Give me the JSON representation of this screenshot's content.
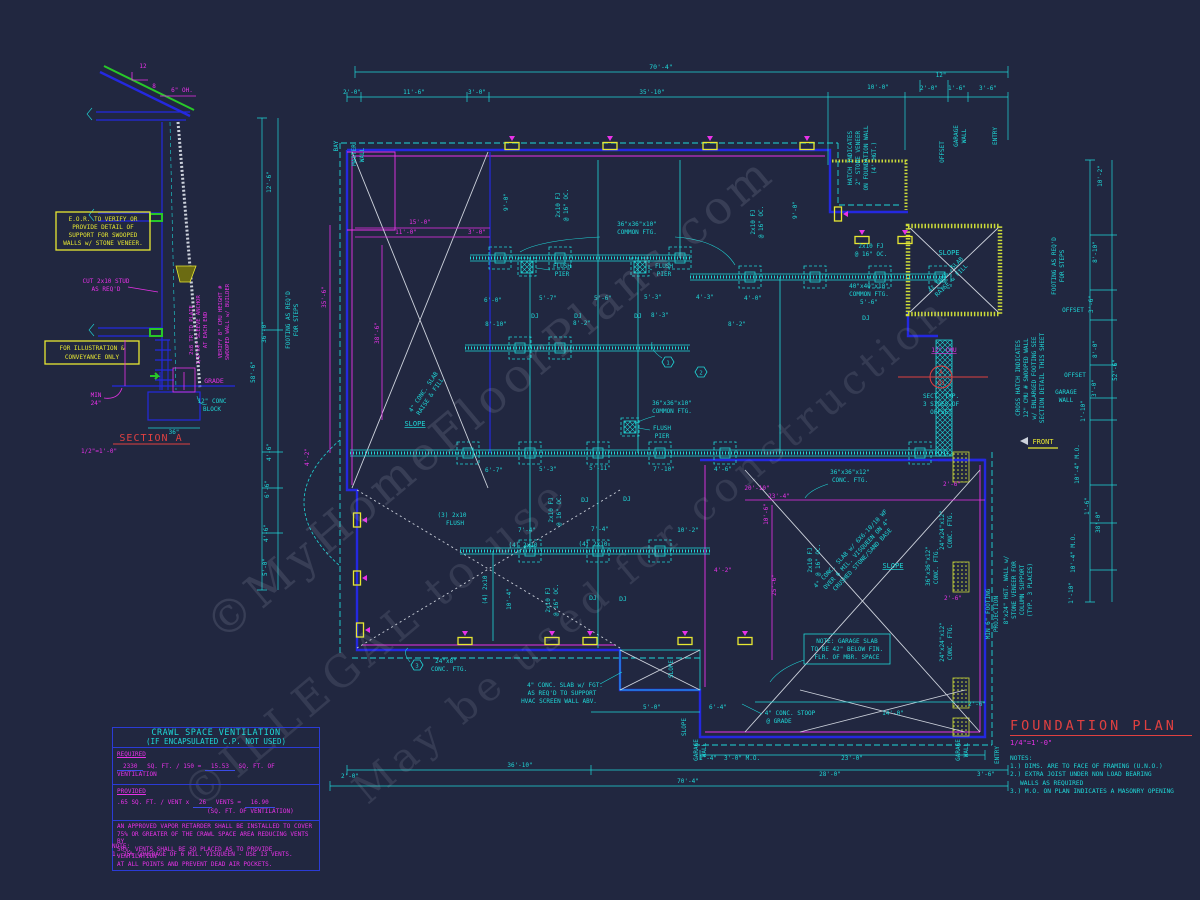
{
  "watermarks": [
    "©MyHomeFloorPlans.com",
    "©ILLEGAL to use",
    "May be used for construction"
  ],
  "section_a": {
    "pitch_rise": "12",
    "pitch_run": "8",
    "overhang": "6\" OH.",
    "note_box1": [
      "E.O.R. TO VERIFY OR",
      "PROVIDE DETAIL OF",
      "SUPPORT FOR SWOOPED",
      "WALLS w/ STONE VENEER."
    ],
    "note_box2": [
      "FOR ILLUSTRATION &",
      "CONVEYANCE ONLY"
    ],
    "cut_stud": [
      "CUT 2x10 STUD",
      "AS REQ'D"
    ],
    "anchor_note": [
      "2x8 TR'TD PLATE",
      "1/2\"x4\" SLEEVE ANCHOR",
      "AT EACH END"
    ],
    "verify_note": [
      "VERIFY 8\" CMU HEIGHT #",
      "SWOOPED WALL w/ BUILDER"
    ],
    "min_label": "MIN",
    "min_val": "24\"",
    "grade": "GRADE",
    "block": [
      "12\" CONC",
      "BLOCK"
    ],
    "footing_width": "36\"",
    "title": "SECTION A",
    "scale": "1/2\"=1'-0\""
  },
  "crawl_table": {
    "title1": "CRAWL SPACE VENTILATION",
    "title2": "(IF ENCAPSULATED C.P. NOT USED)",
    "required": "REQUIRED",
    "req_val": "2330",
    "req_mid": "SQ. FT. / 150 =",
    "req_result": "15.53",
    "req_unit": "SQ. FT. OF VENTILATION",
    "provided": "PROVIDED",
    "prov_pre": ".65 SQ. FT. / VENT x",
    "prov_val": "26",
    "prov_mid": "VENTS =",
    "prov_result": "16.90",
    "prov_unit": "(SQ. FT. OF VENTILATION)",
    "para": [
      "AN APPROVED VAPOR RETARDER SHALL BE INSTALLED TO COVER",
      "75% OR GREATER OF THE CRAWL SPACE AREA REDUCING VENTS BY",
      "50%. VENTS SHALL BE SO PLACED AS TO PROVIDE VENTILATION",
      "AT ALL POINTS AND PREVENT DEAD AIR POCKETS."
    ],
    "note_label": "NOTE:",
    "note1": "1. 75% COVERAGE OF 6 MIL. VISQUEEN - USE 13 VENTS."
  },
  "title_block": {
    "title": "FOUNDATION PLAN",
    "scale": "1/4\"=1'-0\"",
    "notes_label": "NOTES:",
    "notes": [
      "1.) DIMS. ARE TO FACE OF FRAMING (U.N.O.)",
      "2.) EXTRA JOIST UNDER NON LOAD BEARING",
      "WALLS AS REQUIRED",
      "3.) M.O. ON PLAN INDICATES A MASONRY OPENING"
    ]
  },
  "plan": {
    "dims_top": [
      "70'-4\"",
      "2'-0\"",
      "11'-6\"",
      "3'-0\"",
      "35'-10\"",
      "10'-0\"",
      "2'-0\"",
      "12\"",
      "1'-6\"",
      "3'-6\""
    ],
    "tags_top": [
      "BAY",
      "MASTER",
      "WALL",
      "OFFSET",
      "GARAGE",
      "WALL",
      "ENTRY"
    ],
    "dims_left": [
      "12'-6\"",
      "36'-0\"",
      "58'-6\"",
      "4'-6\"",
      "6'-6\"",
      "4'-6\"",
      "5'-0\""
    ],
    "dims_left_m": [
      "35'-6\"",
      "38'-6\"",
      "15'-0\"",
      "11'-0\"",
      "3'-0\"",
      "4'-2\""
    ],
    "dims_right": [
      "10'-2\"",
      "8'-10\"",
      "3'-6\"",
      "8'-0\"",
      "3'-0\"",
      "1'-10\"",
      "10'-4\" M.O.",
      "1'-6\"",
      "38'-0\"",
      "10'-4\" M.O.",
      "1'-10\"",
      "52'-6\""
    ],
    "tags_right": [
      "OFFSET",
      "OFFSET",
      "GARAGE",
      "WALL"
    ],
    "dims_bottom": [
      "2'-0\"",
      "36'-10\"",
      "70'-4\"",
      "5'-0\"",
      "6'-4\"",
      "14'-0\"",
      "2'-6\"",
      "1'-4\"",
      "3'-0\" M.O.",
      "23'-0\"",
      "28'-0\"",
      "3'-6\""
    ],
    "tags_bottom": [
      "SLOPE",
      "GARAGE",
      "WALL",
      "GARAGE",
      "WALL",
      "ENTRY"
    ],
    "dims_inner": [
      "6'-0\"",
      "5'-7\"",
      "5'-6\"",
      "5'-3\"",
      "4'-3\"",
      "4'-0\"",
      "8'-10\"",
      "8'-2\"",
      "8'-3\"",
      "8'-2\"",
      "6'-7\"",
      "5'-3\"",
      "5'-11\"",
      "7'-10\"",
      "4'-6\"",
      "7'-4\"",
      "7'-4\"",
      "10'-2\"",
      "10'-4\"",
      "9'-0\"",
      "9'-0\""
    ],
    "dims_inner_m": [
      "20'-10\"",
      "23'-4\"",
      "10'-6\"",
      "25'-6\"",
      "2'-6\"",
      "2'-6\"",
      "4'-2\""
    ],
    "front_label": "FRONT",
    "slope": "SLOPE",
    "dj": "DJ",
    "fj_note": [
      "2x10 FJ",
      "@ 16\" OC."
    ],
    "labels": {
      "common_ftg_36": [
        "36\"x36\"x10\"",
        "COMMON FTG."
      ],
      "common_ftg_40": [
        "40\"x40\"x10\"",
        "COMMON FTG.",
        "5'-6\""
      ],
      "flush_pier": [
        "FLUSH",
        "PIER"
      ],
      "conc_ftg_3636_12": [
        "36\"x36\"x12\"",
        "CONC. FTG."
      ],
      "conc_ftg_2424_12": [
        "24\"x24\"x12\"",
        "CONC. FTG."
      ],
      "conc_ftg_24x8": [
        "24\"x8\"",
        "CONC. FTG."
      ],
      "slab_raise": [
        "4\" CONC. SLAB",
        "RAISE & FILL"
      ],
      "garage_slab": [
        "4\" CONC. SLAB w/ 6X6-10/10 WF",
        "OVER 6 MIL. VISQUEEN ON 4\"",
        "CRUSHED STONE/SAND BASE"
      ],
      "garage_note": [
        "NOTE: GARAGE SLAB",
        "TO BE 42\" BELOW FIN.",
        "FLR. OF MBR. SPACE"
      ],
      "hvac_note": [
        "4\" CONC. SLAB w/ FGT.",
        "AS REQ'D TO SUPPORT",
        "HVAC SCREEN WALL ABV."
      ],
      "stoop_note": [
        "4\" CONC. STOOP",
        "@ GRADE"
      ],
      "stone_hatch_note": [
        "HATCH INDICATES",
        "2\" STONE VENEER",
        "ON FOUNDATION WALL",
        "(4' HGT.)"
      ],
      "cross_hatch_note": [
        "CROSS HATCH INDICATES",
        "12\" CMU # SWOOPED WALL",
        "w/ ENLARGED FOOTING SEE",
        "SECTION DETAIL THIS SHEET"
      ],
      "footing_steps": [
        "FOOTING AS REQ'D",
        "FOR STEPS"
      ],
      "min_footing": [
        "MIN 6\" FOOTING",
        "PROJECTION"
      ],
      "column_note": [
        "8\"x24\" HGT. WALL w/",
        "STONE VENEER FOR",
        "COLUMN SUPPORT",
        "(TYP. 3 PLACES)"
      ],
      "cmu12": "12\" CMU",
      "sect_a": "A",
      "sect_num": "Ø3",
      "sect_note": [
        "SECT. TYP.",
        "3 SIDES OF",
        "OFFSET"
      ],
      "flush3": [
        "(3) 2x10",
        "FLUSH"
      ],
      "flush4": "(4) 2x10",
      "hex1": "1",
      "hex2": "2",
      "hex3": "3"
    }
  }
}
